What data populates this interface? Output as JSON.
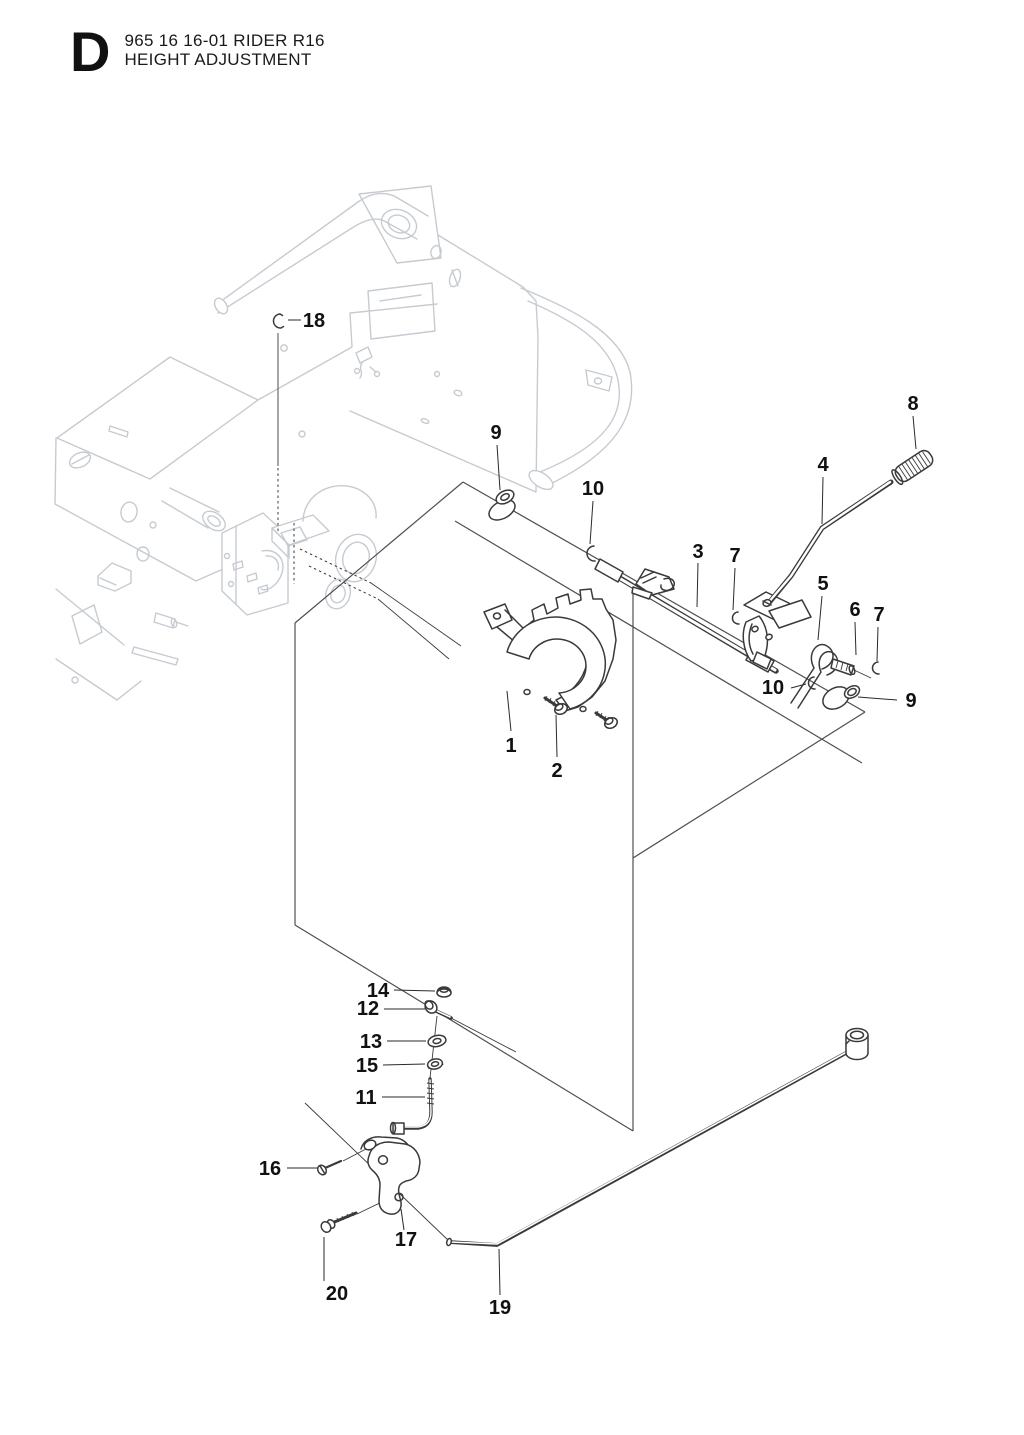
{
  "title": {
    "section_letter": "D",
    "model_line": "965 16 16-01 RIDER R16",
    "section_name": "HEIGHT ADJUSTMENT"
  },
  "diagram": {
    "type": "exploded-parts-diagram",
    "part_numbers_shown": [
      "1",
      "2",
      "3",
      "4",
      "5",
      "6",
      "7",
      "8",
      "9",
      "10",
      "11",
      "12",
      "13",
      "14",
      "15",
      "16",
      "17",
      "18",
      "19",
      "20"
    ],
    "callouts": [
      {
        "n": "1",
        "x": 511,
        "y": 752,
        "lx1": 511,
        "ly1": 731,
        "lx2": 507,
        "ly2": 691
      },
      {
        "n": "2",
        "x": 557,
        "y": 777,
        "lx1": 557,
        "ly1": 757,
        "lx2": 556,
        "ly2": 715
      },
      {
        "n": "3",
        "x": 698,
        "y": 558,
        "lx1": 698,
        "ly1": 563,
        "lx2": 697,
        "ly2": 607
      },
      {
        "n": "4",
        "x": 823,
        "y": 471,
        "lx1": 823,
        "ly1": 477,
        "lx2": 822,
        "ly2": 524
      },
      {
        "n": "5",
        "x": 823,
        "y": 590,
        "lx1": 822,
        "ly1": 596,
        "lx2": 818,
        "ly2": 640
      },
      {
        "n": "6",
        "x": 855,
        "y": 616,
        "lx1": 855,
        "ly1": 622,
        "lx2": 856,
        "ly2": 655
      },
      {
        "n": "7",
        "x": 735,
        "y": 562,
        "lx1": 735,
        "ly1": 568,
        "lx2": 733,
        "ly2": 610
      },
      {
        "n": "7",
        "x": 879,
        "y": 621,
        "lx1": 878,
        "ly1": 627,
        "lx2": 877,
        "ly2": 661
      },
      {
        "n": "8",
        "x": 913,
        "y": 410,
        "lx1": 913,
        "ly1": 416,
        "lx2": 916,
        "ly2": 449
      },
      {
        "n": "9",
        "x": 496,
        "y": 439,
        "lx1": 497,
        "ly1": 445,
        "lx2": 500,
        "ly2": 490
      },
      {
        "n": "9",
        "x": 911,
        "y": 707,
        "lx1": 897,
        "ly1": 700,
        "lx2": 858,
        "ly2": 697
      },
      {
        "n": "10",
        "x": 593,
        "y": 495,
        "lx1": 593,
        "ly1": 501,
        "lx2": 590,
        "ly2": 544
      },
      {
        "n": "10",
        "x": 773,
        "y": 694,
        "lx1": 791,
        "ly1": 688,
        "lx2": 806,
        "ly2": 684
      },
      {
        "n": "11",
        "x": 366,
        "y": 1104,
        "lx1": 382,
        "ly1": 1097,
        "lx2": 425,
        "ly2": 1097
      },
      {
        "n": "12",
        "x": 368,
        "y": 1015,
        "lx1": 384,
        "ly1": 1009,
        "lx2": 425,
        "ly2": 1009
      },
      {
        "n": "13",
        "x": 371,
        "y": 1048,
        "lx1": 387,
        "ly1": 1041,
        "lx2": 426,
        "ly2": 1041
      },
      {
        "n": "14",
        "x": 378,
        "y": 997,
        "lx1": 394,
        "ly1": 990,
        "lx2": 435,
        "ly2": 991
      },
      {
        "n": "15",
        "x": 367,
        "y": 1072,
        "lx1": 383,
        "ly1": 1065,
        "lx2": 425,
        "ly2": 1064
      },
      {
        "n": "16",
        "x": 270,
        "y": 1175,
        "lx1": 287,
        "ly1": 1168,
        "lx2": 317,
        "ly2": 1168
      },
      {
        "n": "17",
        "x": 406,
        "y": 1246,
        "lx1": 404,
        "ly1": 1230,
        "lx2": 401,
        "ly2": 1209
      },
      {
        "n": "18",
        "x": 314,
        "y": 327,
        "lx1": 301,
        "ly1": 320,
        "lx2": 288,
        "ly2": 320
      },
      {
        "n": "19",
        "x": 500,
        "y": 1314,
        "lx1": 500,
        "ly1": 1295,
        "lx2": 499,
        "ly2": 1249
      },
      {
        "n": "20",
        "x": 337,
        "y": 1300,
        "lx1": 324,
        "ly1": 1281,
        "lx2": 324,
        "ly2": 1237
      }
    ],
    "colors": {
      "background": "#ffffff",
      "part_line": "#3a3a3a",
      "frame_line": "#c6cbd1",
      "panel_line": "#4f4f4f",
      "label_color": "#111111"
    }
  }
}
